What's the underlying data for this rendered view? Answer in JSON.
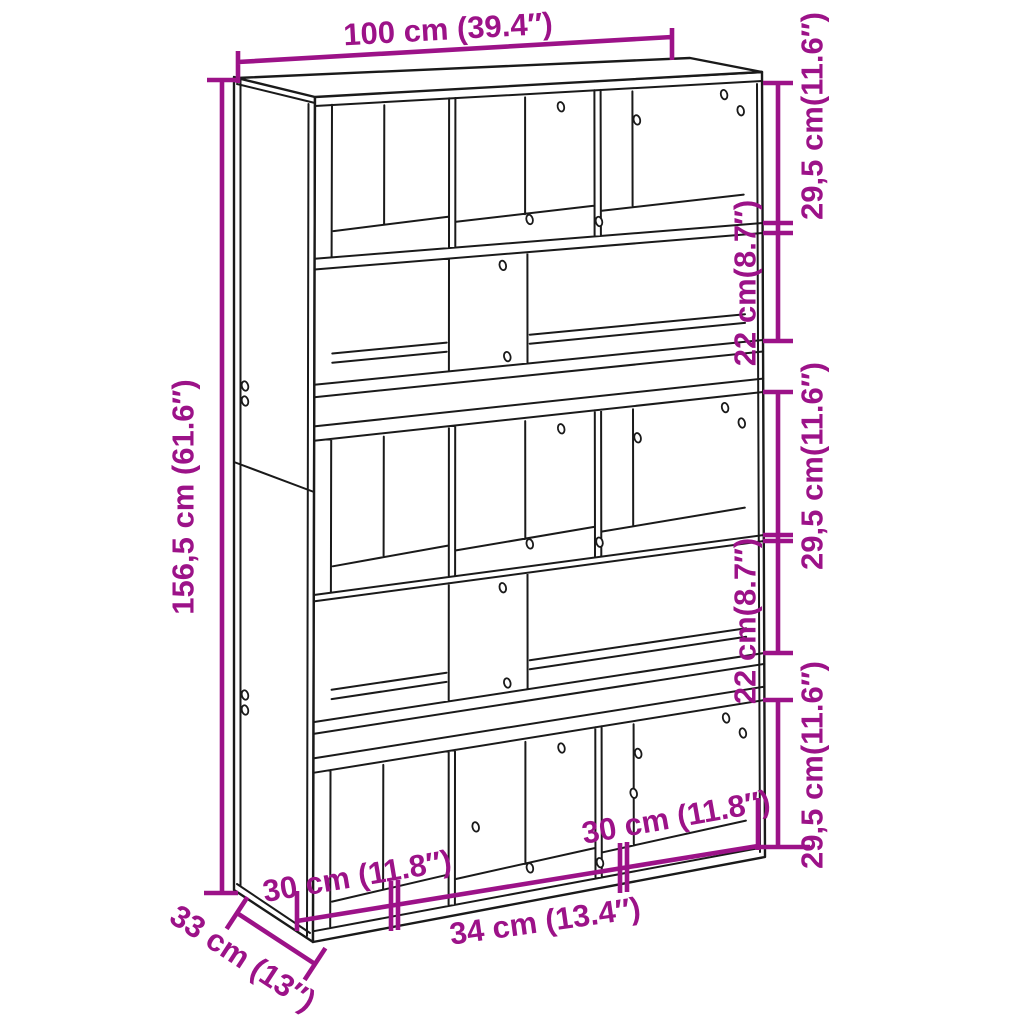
{
  "page": {
    "background": "#ffffff"
  },
  "colors": {
    "dimension_accent": "#9C1288",
    "drawing_line": "#1a1a1a"
  },
  "diagram": {
    "kind": "furniture dimension line drawing",
    "subject": "bookcase room divider with cube compartments"
  },
  "dimensions": {
    "width": {
      "label": "100 cm (39.4″)",
      "position": "top"
    },
    "height": {
      "label": "156,5 cm (61.6″)",
      "position": "left"
    },
    "depth": {
      "label": "33 cm (13″)",
      "position": "bottom-left"
    },
    "right_sections": [
      {
        "label": "29,5 cm(11.6″)"
      },
      {
        "label": "22 cm(8.7″)"
      },
      {
        "label": "29,5 cm(11.6″)"
      },
      {
        "label": "22 cm(8.7″)"
      },
      {
        "label": "29,5 cm(11.6″)"
      }
    ],
    "bottom_sections": [
      {
        "label": "30 cm (11.8″)"
      },
      {
        "label": "34 cm (13.4″)"
      },
      {
        "label": "30 cm (11.8″)"
      }
    ]
  }
}
